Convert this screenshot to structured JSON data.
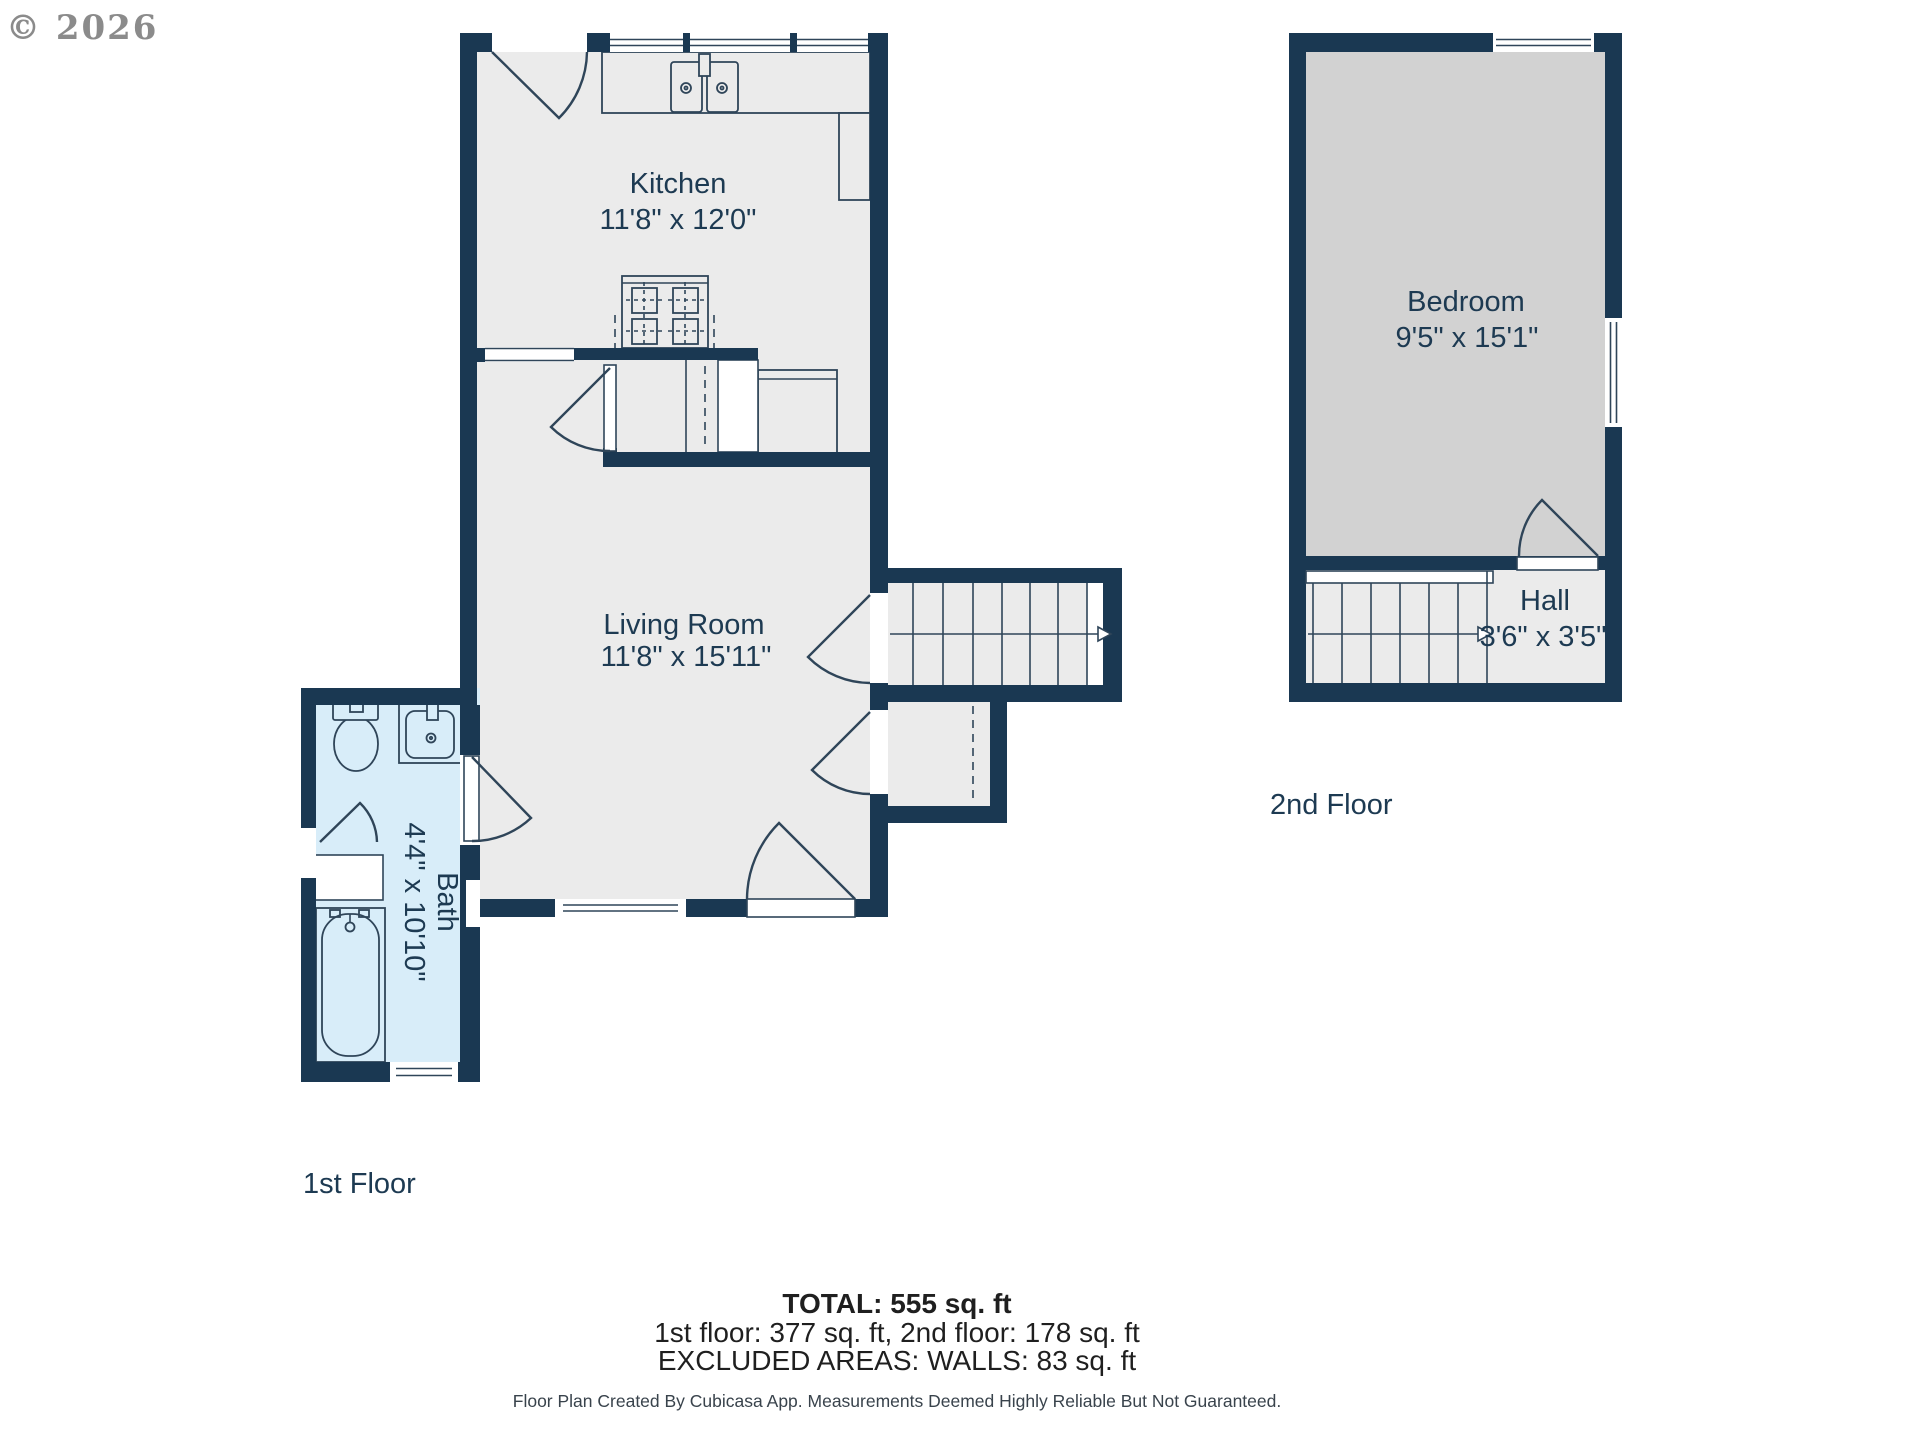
{
  "watermark": "© 2026",
  "colors": {
    "wall": "#1a3852",
    "stroke": "#2f4559",
    "floor": "#ebebeb",
    "bath": "#d8edf9",
    "bedroom": "#d2d2d2",
    "label_text": "#1d3a52",
    "summary_text": "#1f1f1f",
    "disclaimer_text": "#39434c",
    "watermark_gray": "#8b8b8b"
  },
  "floors": {
    "first": {
      "label": "1st Floor",
      "rooms": [
        {
          "name": "Kitchen",
          "dimensions": "11'8\" x 12'0\""
        },
        {
          "name": "Living Room",
          "dimensions": "11'8\" x 15'11\""
        },
        {
          "name": "Bath",
          "dimensions": "4'4\" x 10'10\""
        }
      ]
    },
    "second": {
      "label": "2nd Floor",
      "rooms": [
        {
          "name": "Bedroom",
          "dimensions": "9'5\" x 15'1\""
        },
        {
          "name": "Hall",
          "dimensions": "3'6\" x 3'5\""
        }
      ]
    }
  },
  "summary": {
    "total": "TOTAL: 555 sq. ft",
    "floors_breakdown": "1st floor: 377 sq. ft, 2nd floor: 178 sq. ft",
    "excluded": "EXCLUDED AREAS: WALLS: 83 sq. ft",
    "disclaimer": "Floor Plan Created By Cubicasa App. Measurements Deemed Highly Reliable But Not Guaranteed."
  }
}
